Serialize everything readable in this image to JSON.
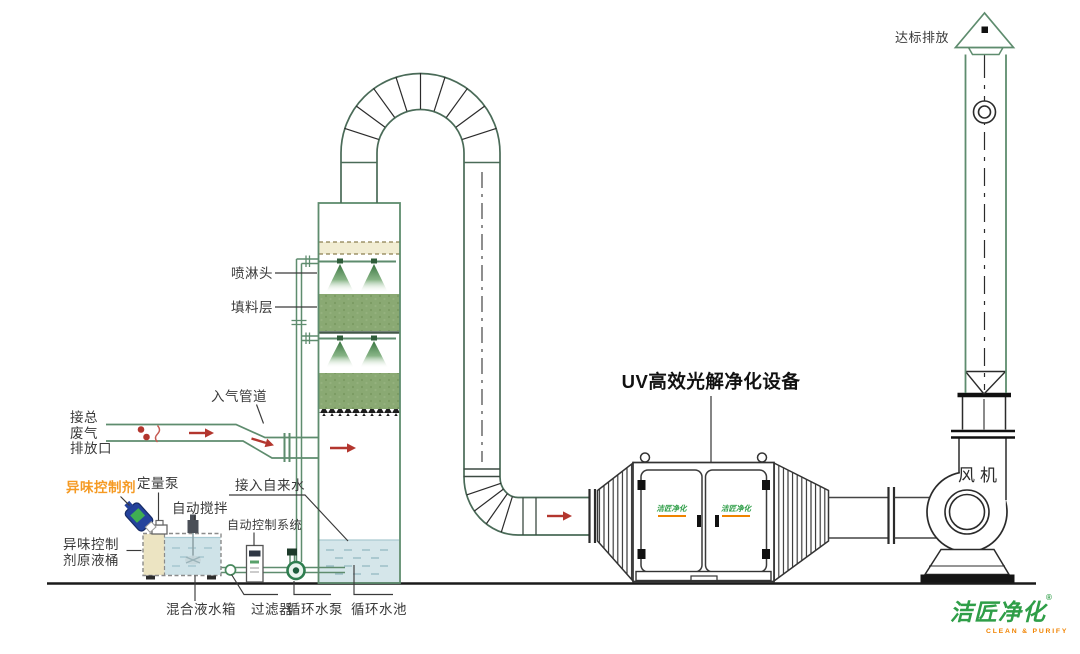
{
  "title": {
    "uv_unit": "UV高效光解净化设备"
  },
  "tower": {
    "spray_head": "喷淋头",
    "packing_layer": "填料层",
    "inlet_duct": "入气管道",
    "waste_inlet": "接总\n废气\n排放口",
    "tap_water": "接入自来水",
    "circ_pool": "循环水池"
  },
  "dosing": {
    "odor_agent": "异味控制剂",
    "metering_pump": "定量泵",
    "auto_stir": "自动搅拌",
    "auto_control": "自动控制系统",
    "agent_barrel": "异味控制\n剂原液桶",
    "mix_tank": "混合液水箱",
    "filter": "过滤器",
    "circ_pump": "循环水泵"
  },
  "right_side": {
    "fan": "风机",
    "discharge": "达标排放"
  },
  "logo": {
    "name": "洁匠净化",
    "reg": "®",
    "tagline": "CLEAN & PURIFY",
    "door_left": "洁匠净化",
    "door_right": "洁匠净化"
  },
  "colors": {
    "pipe_green": "#5E8C6E",
    "duct_green": "#4A6B58",
    "packing_green": "#8AA973",
    "cone_green": "#35713D",
    "water_blue": "#D5E6EA",
    "demister_beige": "#F2EDD3",
    "arrow_red": "#B3362E",
    "label_orange": "#F59A23",
    "logo_green": "#2F9E48",
    "logo_orange": "#F08300",
    "bottle_blue": "#24429C",
    "line_black": "#2B2B2B"
  }
}
